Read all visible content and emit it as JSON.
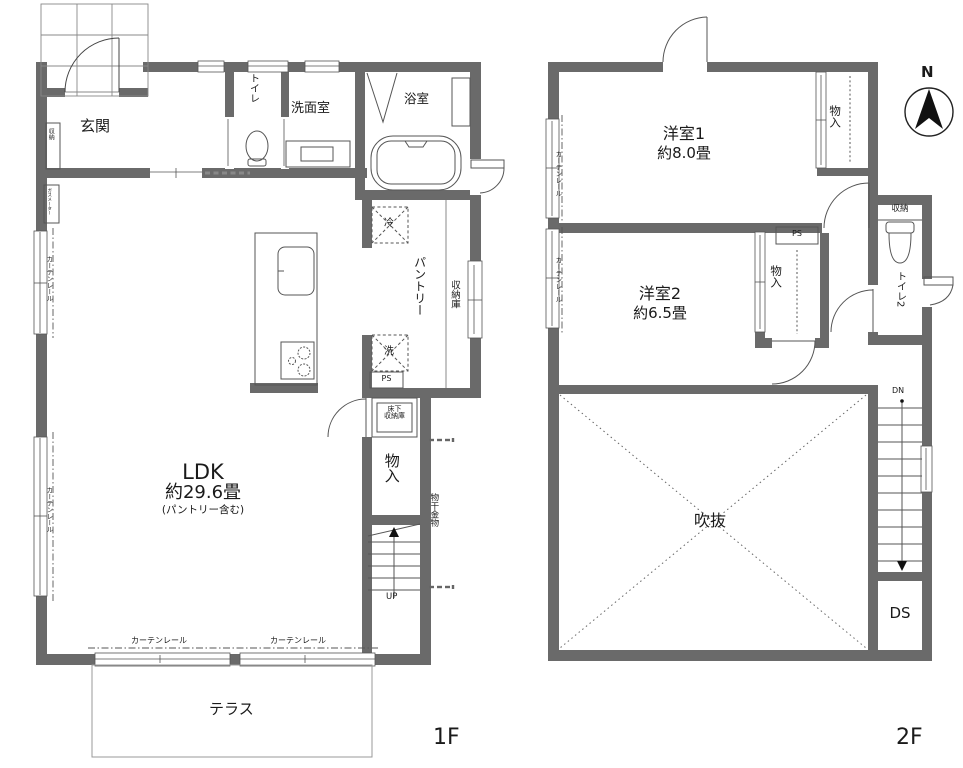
{
  "compass_n": "N",
  "f1": {
    "label": "1F",
    "genkan": "玄関",
    "toilet": "トイレ",
    "washroom": "洗面室",
    "bath": "浴室",
    "closet": "収納",
    "gas_meter": "ガスメーター",
    "curtain_rail": "カーテンレール",
    "fridge": "冷",
    "washer": "洗",
    "ps": "PS",
    "pantry": "パントリー",
    "storage": "収納庫",
    "underfloor1": "床下",
    "underfloor2": "収納庫",
    "monoire": "物入",
    "laundry": "物干金物",
    "up": "UP",
    "ldk_name": "LDK",
    "ldk_size": "約29.6畳",
    "ldk_note": "(パントリー含む)",
    "terrace": "テラス"
  },
  "f2": {
    "label": "2F",
    "room1_name": "洋室1",
    "room1_size": "約8.0畳",
    "room2_name": "洋室2",
    "room2_size": "約6.5畳",
    "monoire": "物入",
    "ps": "PS",
    "closet": "収納",
    "toilet2": "トイレ2",
    "dn": "DN",
    "atrium": "吹抜",
    "ds": "DS",
    "curtain_rail": "カーテンレール"
  }
}
